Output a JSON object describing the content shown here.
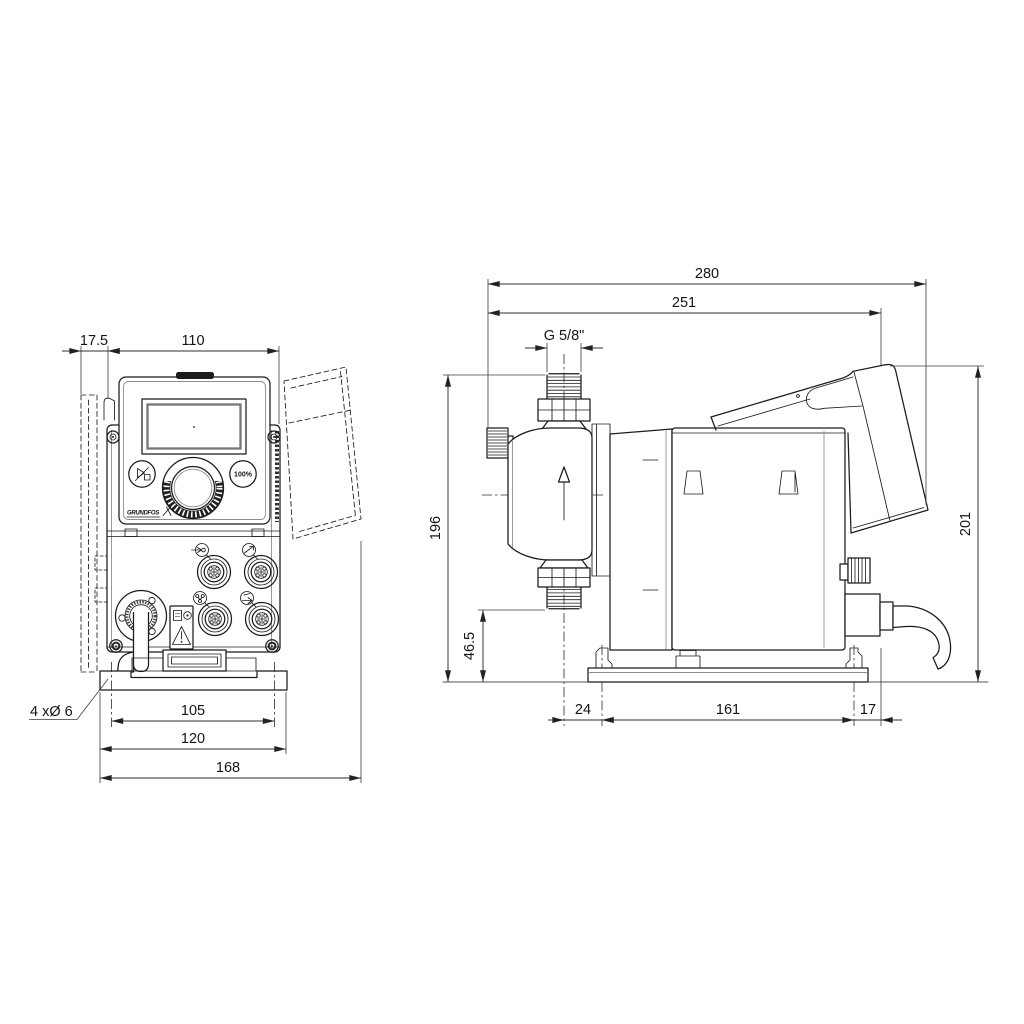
{
  "front_view": {
    "dim_wall_clearance": "17.5",
    "dim_control_width": "110",
    "dim_hole_spacing": "105",
    "dim_plate_width": "120",
    "dim_overall_width": "168",
    "mounting_holes_note": "4 xØ 6",
    "control_panel": {
      "capacity_button_label": "100%",
      "brand_logo": "GRUNDFOS"
    }
  },
  "side_view": {
    "dim_overall_depth": "280",
    "dim_depth_to_hood": "251",
    "thread_label": "G 5/8\"",
    "dim_connection_height": "196",
    "dim_suction_valve_height": "46.5",
    "dim_overall_height": "201",
    "dim_valve_to_base": "24",
    "dim_base_length": "161",
    "dim_base_to_gland": "17"
  },
  "colors": {
    "line": "#1b1b1b",
    "dimension": "#2f2f2f",
    "background": "#ffffff"
  }
}
